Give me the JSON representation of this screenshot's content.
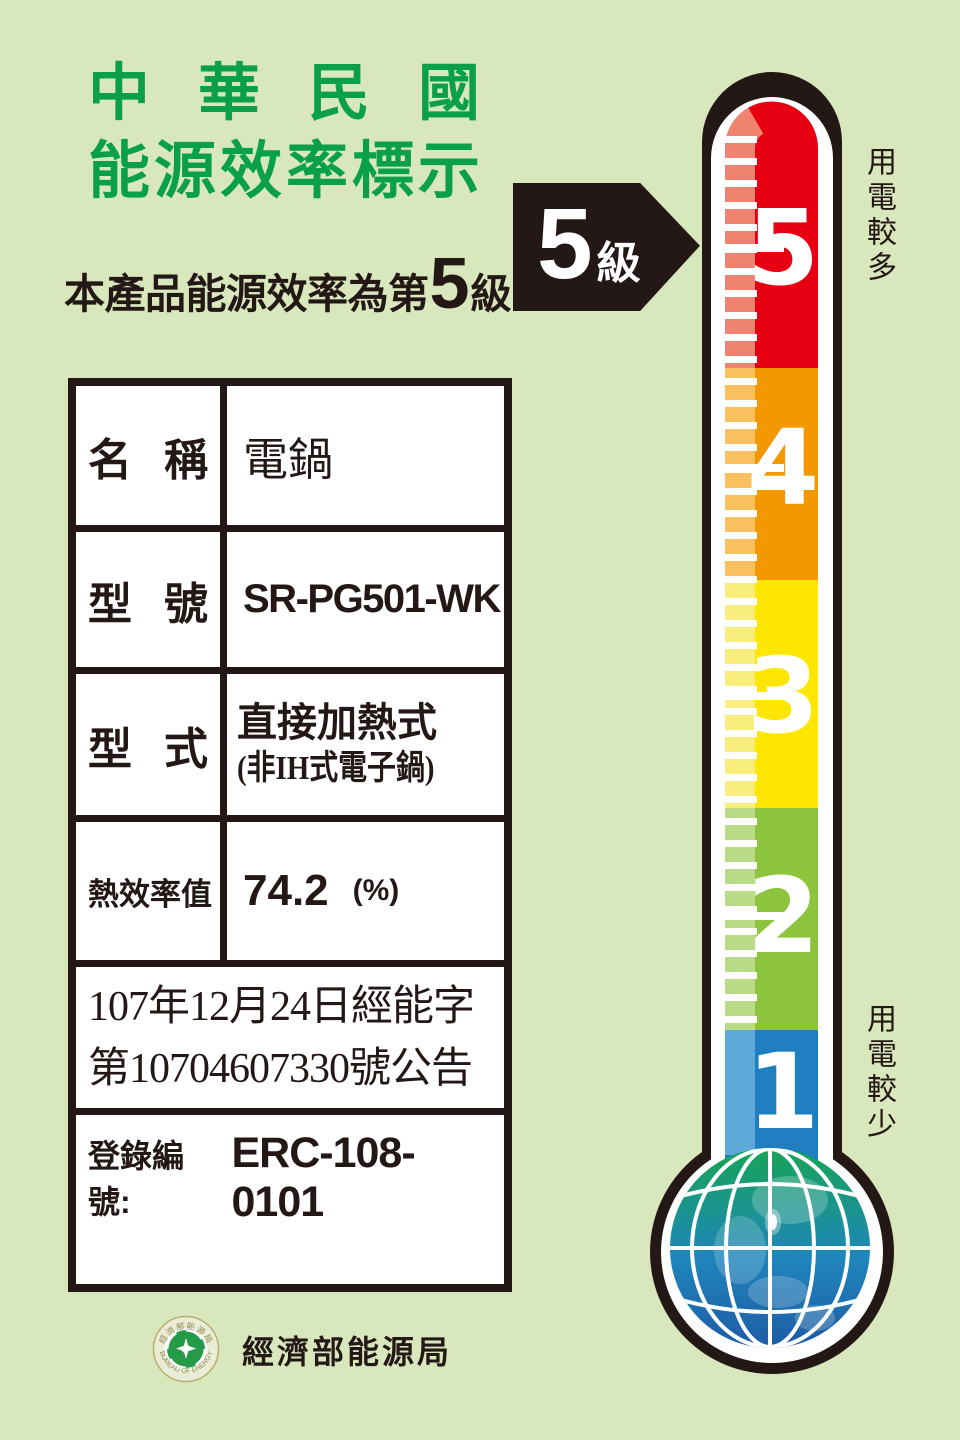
{
  "colors": {
    "background": "#d9e7bd",
    "ink": "#231815",
    "title_green": "#0aa04a",
    "table_background": "#ffffff"
  },
  "header": {
    "title_line1": "中華民國",
    "title_line2": "能源效率標示",
    "subtitle_prefix": "本產品能源效率為第",
    "subtitle_level": "5",
    "subtitle_suffix": "級"
  },
  "badge": {
    "level": "5",
    "unit": "級"
  },
  "scale": {
    "more_label": "用電較多",
    "less_label": "用電較少",
    "levels": [
      {
        "value": "5",
        "color": "#e60012",
        "band": "#f0836f"
      },
      {
        "value": "4",
        "color": "#f39800",
        "band": "#f8c05f"
      },
      {
        "value": "3",
        "color": "#ffe600",
        "band": "#f7ee7d"
      },
      {
        "value": "2",
        "color": "#8cc43d",
        "band": "#b9da86"
      },
      {
        "value": "1",
        "color": "#1f7fc0",
        "band": "#5ea9d8"
      }
    ]
  },
  "globe": {
    "top": "#16a456",
    "mid": "#1f86bb",
    "bottom": "#1e5ba5"
  },
  "table": {
    "rows": [
      {
        "label": "名稱",
        "value": "電鍋"
      },
      {
        "label": "型號",
        "value": "SR-PG501-WK"
      },
      {
        "label": "型式",
        "value_line1": "直接加熱式",
        "value_line2": "(非IH式電子鍋)"
      },
      {
        "label": "熱效率值",
        "value": "74.2",
        "unit": "(%)"
      }
    ],
    "announcement_line1": "107年12月24日經能字",
    "announcement_line2": "第10704607330號公告",
    "registration_label": "登錄編號:",
    "registration_value": "ERC-108-0101"
  },
  "footer": {
    "bureau_name": "經濟部能源局",
    "seal_text_top": "經濟部能源局",
    "seal_text_bottom": "BUREAU OF ENERGY"
  }
}
